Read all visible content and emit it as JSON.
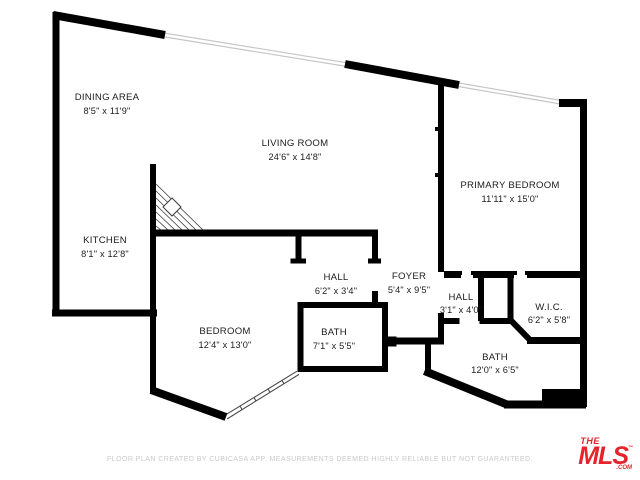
{
  "rooms": [
    {
      "name": "DINING AREA",
      "dims": "8'5\" x 11'9\""
    },
    {
      "name": "LIVING ROOM",
      "dims": "24'6\" x 14'8\""
    },
    {
      "name": "PRIMARY BEDROOM",
      "dims": "11'11\" x 15'0\""
    },
    {
      "name": "KITCHEN",
      "dims": "8'1\" x 12'8\""
    },
    {
      "name": "HALL",
      "dims": "6'2\" x 3'4\""
    },
    {
      "name": "FOYER",
      "dims": "5'4\" x 9'5\""
    },
    {
      "name": "HALL",
      "dims": "3'1\" x 4'0\""
    },
    {
      "name": "W.I.C.",
      "dims": "6'2\" x 5'8\""
    },
    {
      "name": "BEDROOM",
      "dims": "12'4\" x 13'0\""
    },
    {
      "name": "BATH",
      "dims": "7'1\" x 5'5\""
    },
    {
      "name": "BATH",
      "dims": "12'0\" x 6'5\""
    }
  ],
  "footer": {
    "disclaimer": "FLOOR PLAN CREATED BY CUBICASA APP. MEASUREMENTS DEEMED HIGHLY RELIABLE BUT NOT GUARANTEED."
  },
  "logo": {
    "the": "THE",
    "name": "MLS",
    "tm": "™",
    "com": ".COM"
  },
  "colors": {
    "walls": "#000000",
    "background": "#ffffff",
    "label_text": "#1c1c1c",
    "disclaimer_gray": "#c9c9c9",
    "logo_red": "#e4232b",
    "window_gray": "#c6c6c6"
  }
}
